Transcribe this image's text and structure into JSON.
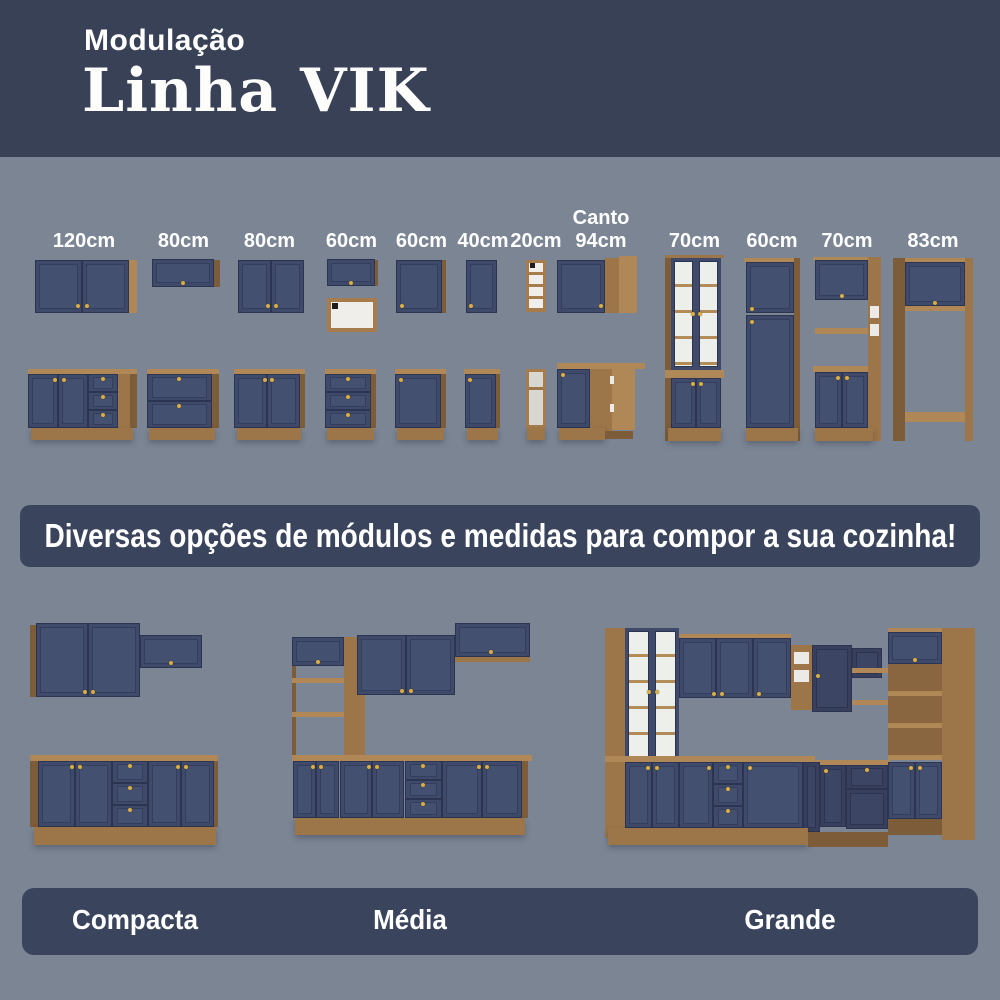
{
  "header": {
    "subtitle": "Modulação",
    "title": "Linha VIK"
  },
  "modules": [
    {
      "label": "120cm"
    },
    {
      "label": "80cm"
    },
    {
      "label": "80cm"
    },
    {
      "label": "60cm"
    },
    {
      "label": "60cm"
    },
    {
      "label": "40cm"
    },
    {
      "label": "20cm"
    },
    {
      "label_line1": "Canto",
      "label_line2": "94cm"
    },
    {
      "label": "70cm"
    },
    {
      "label": "60cm"
    },
    {
      "label": "70cm"
    },
    {
      "label": "83cm"
    }
  ],
  "banner": {
    "text": "Diversas opções de módulos e medidas para compor a sua cozinha!"
  },
  "kitchens": [
    {
      "name": "Compacta"
    },
    {
      "name": "Média"
    },
    {
      "name": "Grande"
    }
  ],
  "colors": {
    "header_navy": "#384156",
    "body_background": "#7b8594",
    "cabinet_navy": "#3f4a6a",
    "wood": "#9c7548",
    "knob_gold": "#d8ae45"
  }
}
